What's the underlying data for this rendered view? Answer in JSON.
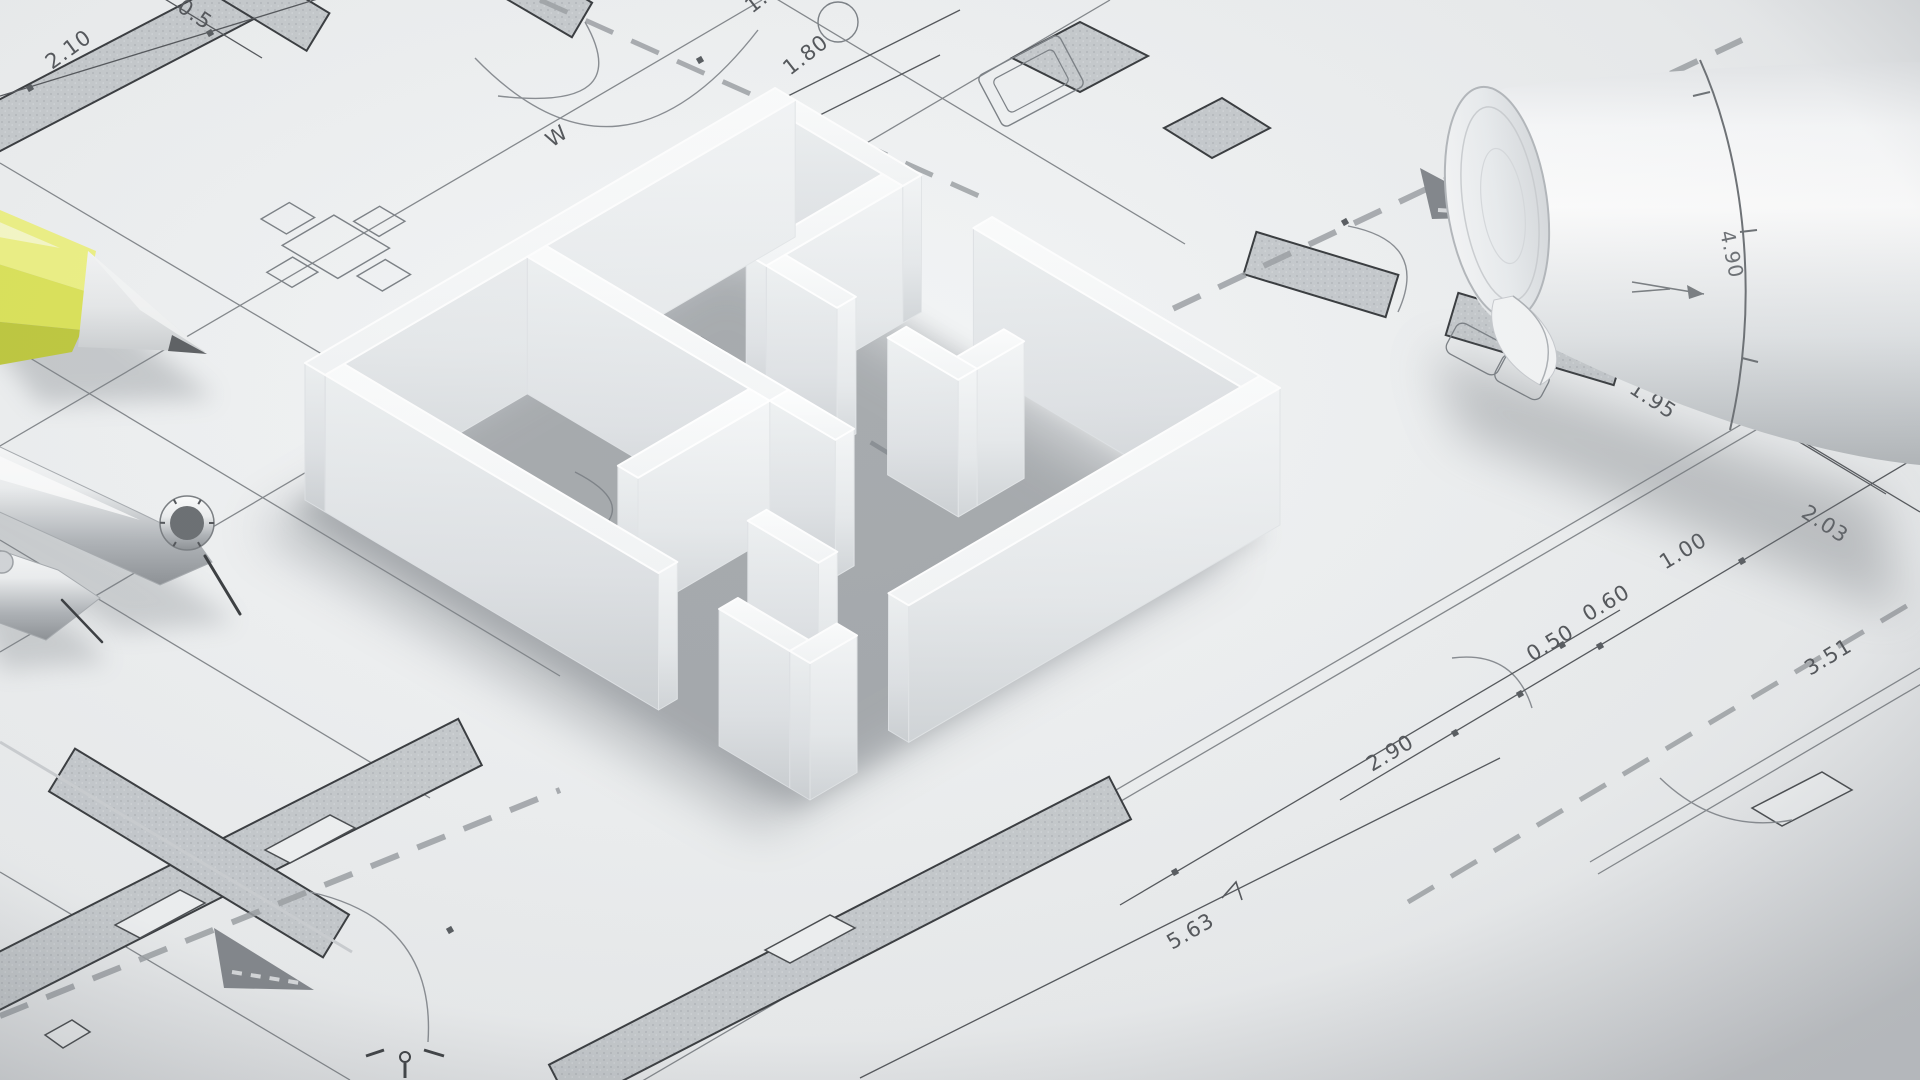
{
  "scene": {
    "subject": "White 3D-printed floor plan model standing on an architectural blueprint drawing, with a yellow pencil, chrome drafting compass and divider on the left and a rolled-up plan at the top right",
    "type": "photorealistic-3d-render"
  },
  "palette": {
    "paper": "#eff1f2",
    "paper_dark": "#dcdfe2",
    "line_thin": "#85898d",
    "line_dark": "#3a3d40",
    "hatch_fill": "#c7cbce",
    "dash_gray": "#9ea2a6",
    "dim_text": "#55585c",
    "triangle_gray": "#84888d",
    "model_top": "#fbfcfd",
    "model_face_light": "#f4f6f7",
    "model_face_dark": "#d2d6d9",
    "shadow": "#84898e",
    "pencil_yellow_light": "#eef286",
    "pencil_yellow": "#dde45c",
    "pencil_yellow_dark": "#c0ca41",
    "pencil_wood": "#e8eaeb",
    "pencil_tip": "#5f6265",
    "chrome_light": "#fdfefe",
    "chrome_dark": "#8f9397",
    "roll_bright": "#ffffff",
    "roll_shade": "#c2c6c9"
  },
  "blueprint": {
    "dimension_labels": [
      {
        "label": "2.10",
        "x": 52,
        "y": 70,
        "rot": -36
      },
      {
        "label": "0.5",
        "x": 176,
        "y": 10,
        "rot": 34
      },
      {
        "label": "1.93",
        "x": 752,
        "y": 14,
        "rot": -38
      },
      {
        "label": "1.80",
        "x": 790,
        "y": 76,
        "rot": -38
      },
      {
        "label": "W",
        "x": 552,
        "y": 148,
        "rot": -35
      },
      {
        "label": "1.95",
        "x": 1628,
        "y": 392,
        "rot": 33
      },
      {
        "label": "2.03",
        "x": 1800,
        "y": 516,
        "rot": 33
      },
      {
        "label": "1.00",
        "x": 1665,
        "y": 570,
        "rot": -31
      },
      {
        "label": "0.60",
        "x": 1588,
        "y": 622,
        "rot": -31
      },
      {
        "label": "0.50",
        "x": 1532,
        "y": 662,
        "rot": -31
      },
      {
        "label": "3.51",
        "x": 1810,
        "y": 676,
        "rot": -31
      },
      {
        "label": "2.90",
        "x": 1372,
        "y": 772,
        "rot": -31
      },
      {
        "label": "5.63",
        "x": 1172,
        "y": 950,
        "rot": -30
      },
      {
        "label": "4.90",
        "x": 1720,
        "y": 232,
        "rot": 78
      }
    ]
  }
}
